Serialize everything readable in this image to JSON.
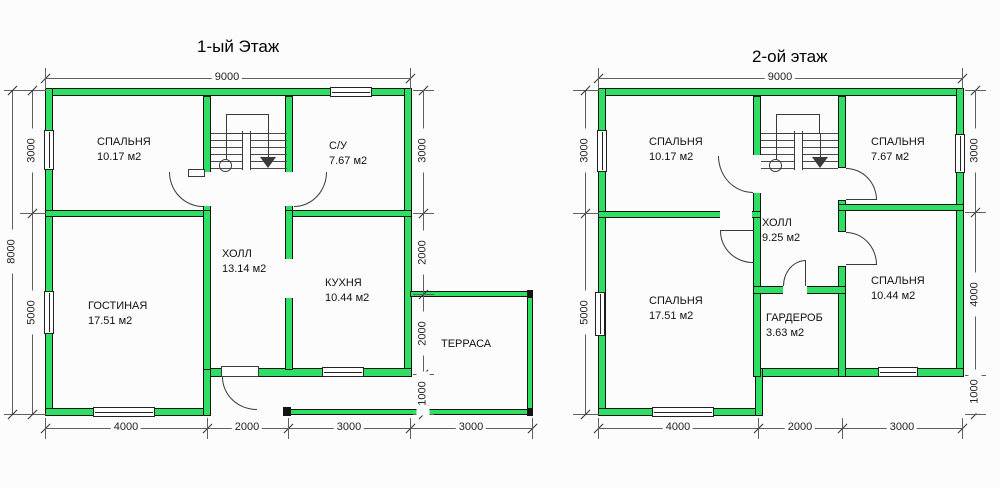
{
  "floor1": {
    "title": "1-ый Этаж",
    "rooms": [
      {
        "name": "СПАЛЬНЯ",
        "area": "10.17 м2"
      },
      {
        "name": "С/У",
        "area": "7.67 м2"
      },
      {
        "name": "ХОЛЛ",
        "area": "13.14 м2"
      },
      {
        "name": "КУХНЯ",
        "area": "10.44 м2"
      },
      {
        "name": "ГОСТИНАЯ",
        "area": "17.51 м2"
      },
      {
        "name": "ТЕРРАСА",
        "area": ""
      }
    ],
    "dims": {
      "top": [
        "9000"
      ],
      "bottom": [
        "4000",
        "2000",
        "3000",
        "3000"
      ],
      "left_outer": [
        "8000"
      ],
      "left_inner": [
        "3000",
        "5000"
      ],
      "right": [
        "3000",
        "2000",
        "2000",
        "1000"
      ]
    }
  },
  "floor2": {
    "title": "2-ой этаж",
    "rooms": [
      {
        "name": "СПАЛЬНЯ",
        "area": "10.17 м2"
      },
      {
        "name": "СПАЛЬНЯ",
        "area": "7.67 м2"
      },
      {
        "name": "ХОЛЛ",
        "area": "9.25 м2"
      },
      {
        "name": "СПАЛЬНЯ",
        "area": "17.51 м2"
      },
      {
        "name": "ГАРДЕРОБ",
        "area": "3.63 м2"
      },
      {
        "name": "СПАЛЬНЯ",
        "area": "10.44 м2"
      }
    ],
    "dims": {
      "top": [
        "9000"
      ],
      "bottom": [
        "4000",
        "2000",
        "3000"
      ],
      "left": [
        "3000",
        "5000"
      ],
      "right": [
        "3000",
        "4000",
        "1000"
      ]
    }
  },
  "colors": {
    "wall_green": "#2ddf63",
    "line": "#3a3a3a"
  }
}
